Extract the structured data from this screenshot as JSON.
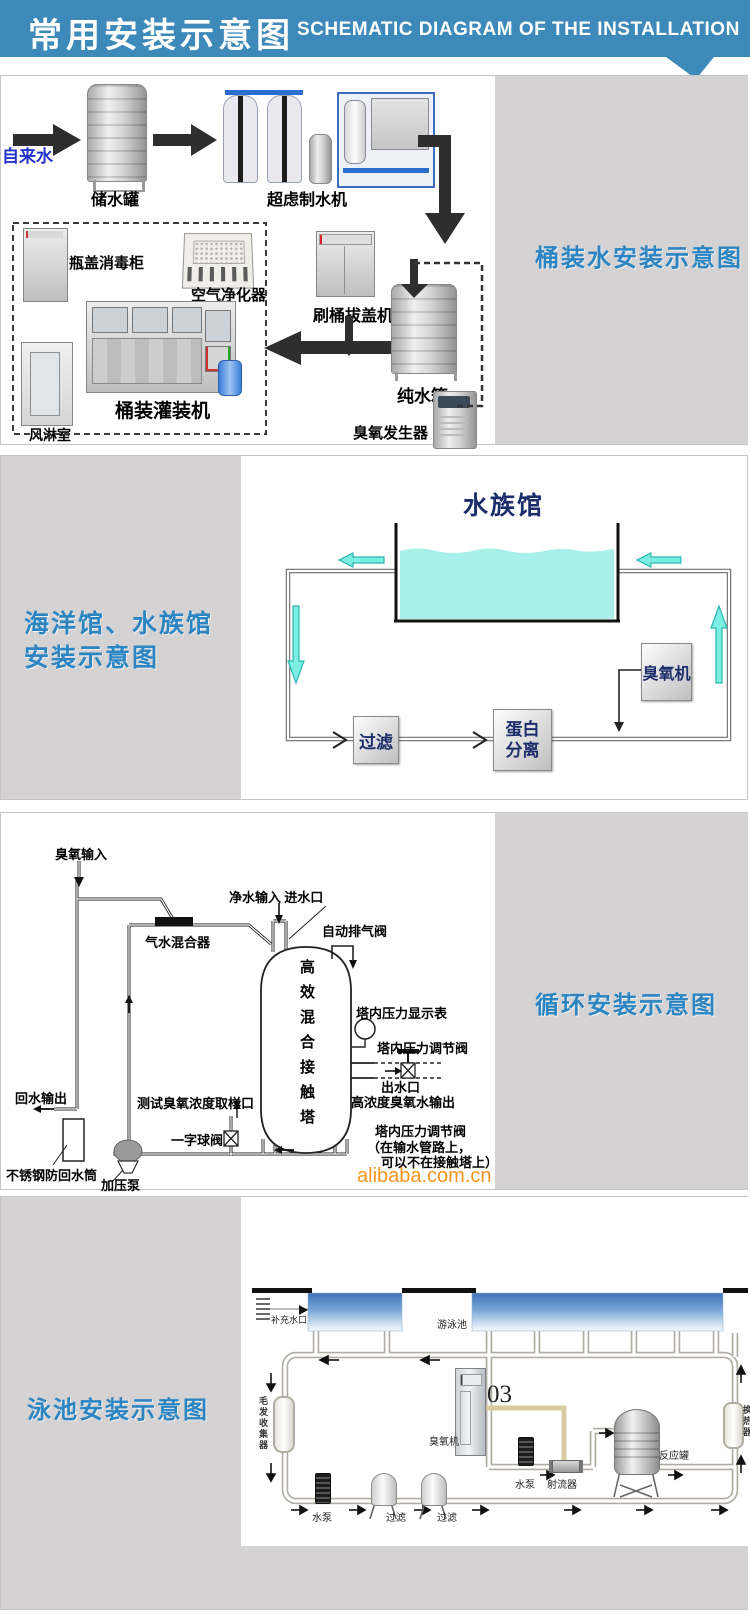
{
  "header": {
    "title_cn": "常用安装示意图",
    "title_en": "SCHEMATIC DIAGRAM OF THE INSTALLATION"
  },
  "s1": {
    "label": "桶装水安装示意图",
    "tap_water": "自来水",
    "storage_tank": "储水罐",
    "uf_machine": "超虑制水机",
    "cap_sterilizer": "瓶盖消毒柜",
    "air_purifier": "空气净化器",
    "filling_machine": "桶装灌装机",
    "air_shower": "风淋室",
    "brush_machine": "刷桶拔盖机",
    "pure_tank": "纯水箱",
    "ozone_generator": "臭氧发生器"
  },
  "s2": {
    "label_line1": "海洋馆、水族馆",
    "label_line2": "安装示意图",
    "aquarium_title": "水族馆",
    "filter": "过滤",
    "protein_line1": "蛋白",
    "protein_line2": "分离",
    "ozone_machine": "臭氧机"
  },
  "s3": {
    "label": "循环安装示意图",
    "ozone_input": "臭氧输入",
    "gas_water_mixer": "气水混合器",
    "clean_water_input": "净水输入 进水口",
    "auto_exhaust_valve": "自动排气阀",
    "tower_vertical": "高效混合接触塔",
    "pressure_gauge": "塔内压力显示表",
    "pressure_valve": "塔内压力调节阀",
    "outlet": "出水口",
    "ozone_water_out": "高浓度臭氧水输出",
    "note_line1": "塔内压力调节阀",
    "note_line2": "（在输水管路上，",
    "note_line3": "可以不在接触塔上）",
    "sampling_port": "测试臭氧浓度取样口",
    "ball_valve": "一字球阀",
    "return_output": "回水输出",
    "anti_backflow": "不锈钢防回水筒",
    "pressure_pump": "加压泵",
    "watermark": "alibaba.com.cn"
  },
  "s4": {
    "label": "泳池安装示意图",
    "makeup_inlet": "补充水口",
    "pool": "游泳池",
    "hair_collector": "毛发收集器",
    "ozone_machine": "臭氧机",
    "o3": "03",
    "pump_mid": "水泵",
    "injector": "射流器",
    "reaction_tank": "反应罐",
    "heat_exchanger": "换热器",
    "pump_bottom": "水泵",
    "filter1": "过滤",
    "filter2": "过滤"
  },
  "colors": {
    "header_blue": "#3d8aba",
    "section_label_blue": "#2b85c2",
    "watermark_orange": "#f7941d",
    "water_cyan": "#a9f0eb",
    "arrow_cyan": "#7ceee4",
    "pool_blue": "#3f74b8",
    "diagram_navy": "#1c2d6b",
    "panel_gray": "#d4d2d3"
  }
}
